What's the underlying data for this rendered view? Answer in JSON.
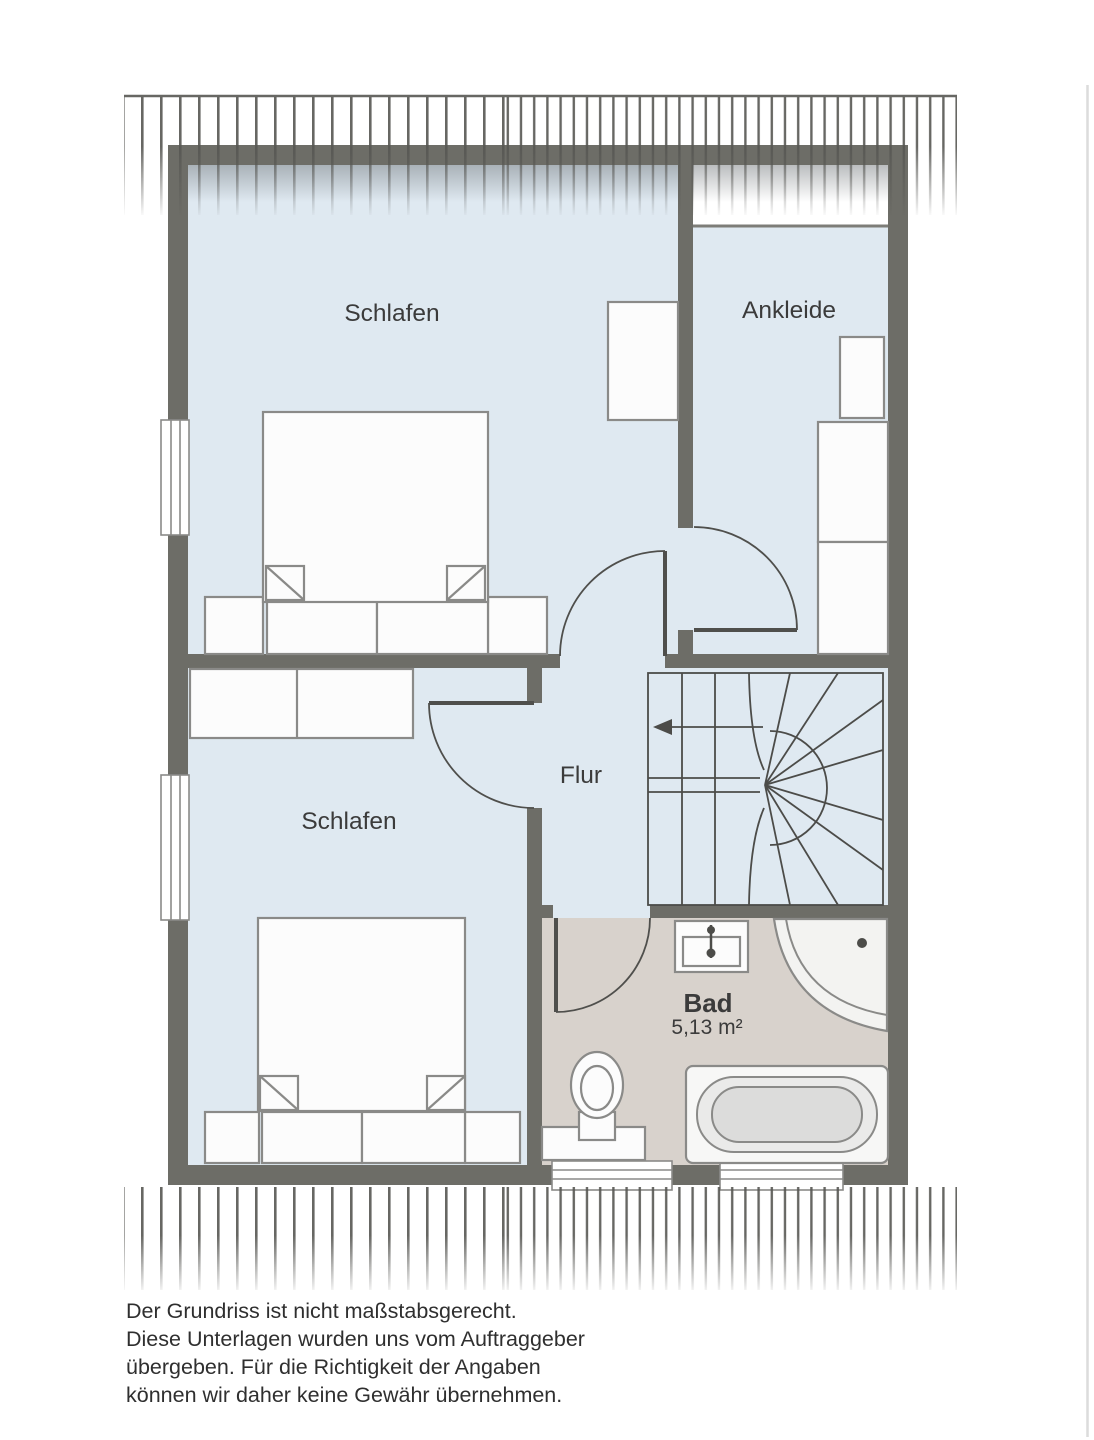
{
  "floorplan": {
    "labels": {
      "bedroom_top": "Schlafen",
      "bedroom_bottom": "Schlafen",
      "dressing_room": "Ankleide",
      "hallway": "Flur",
      "bathroom": "Bad",
      "bathroom_area": "5,13 m²"
    },
    "colors": {
      "wall": "#6d6d67",
      "room": "#dfe9f1",
      "bath": "#d8d2cc",
      "furniture_stroke": "#8a8a88",
      "furniture_fill": "#fcfcfc",
      "door_stroke": "#4f4f4c",
      "stair_stroke": "#4c4c49",
      "hatch": "#575753",
      "label_text": "#3b3b3b",
      "disclaimer_text": "#2f2f2f"
    }
  },
  "disclaimer": {
    "line1": "Der Grundriss ist nicht maßstabsgerecht.",
    "line2": "Diese Unterlagen wurden uns vom Auftraggeber",
    "line3": "übergeben. Für die Richtigkeit der Angaben",
    "line4": "können wir daher keine Gewähr übernehmen."
  }
}
